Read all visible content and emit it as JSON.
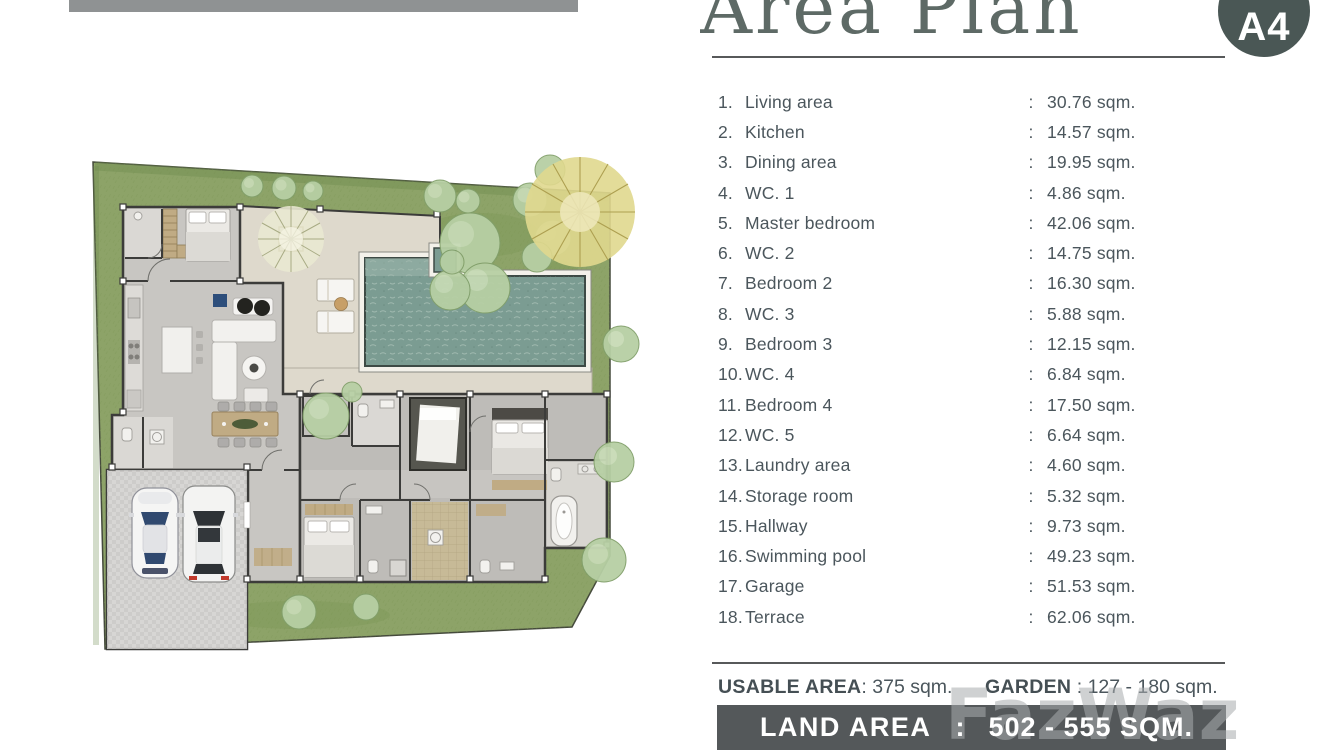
{
  "header": {
    "title": "Area Plan",
    "badge": "A4"
  },
  "misc": {
    "colon": ":"
  },
  "rooms": [
    {
      "no": "1.",
      "name": "Living area",
      "area": "30.76 sqm."
    },
    {
      "no": "2.",
      "name": "Kitchen",
      "area": "14.57 sqm."
    },
    {
      "no": "3.",
      "name": "Dining area",
      "area": "19.95 sqm."
    },
    {
      "no": "4.",
      "name": "WC. 1",
      "area": "4.86 sqm."
    },
    {
      "no": "5.",
      "name": "Master bedroom",
      "area": "42.06 sqm."
    },
    {
      "no": "6.",
      "name": "WC. 2",
      "area": "14.75 sqm."
    },
    {
      "no": "7.",
      "name": "Bedroom 2",
      "area": "16.30 sqm."
    },
    {
      "no": "8.",
      "name": "WC. 3",
      "area": "5.88 sqm."
    },
    {
      "no": "9.",
      "name": "Bedroom 3",
      "area": "12.15 sqm."
    },
    {
      "no": "10.",
      "name": "WC. 4",
      "area": "6.84 sqm."
    },
    {
      "no": "11.",
      "name": "Bedroom 4",
      "area": "17.50 sqm."
    },
    {
      "no": "12.",
      "name": "WC. 5",
      "area": "6.64 sqm."
    },
    {
      "no": "13.",
      "name": "Laundry area",
      "area": "4.60 sqm."
    },
    {
      "no": "14.",
      "name": "Storage room",
      "area": "5.32 sqm."
    },
    {
      "no": "15.",
      "name": "Hallway",
      "area": "9.73 sqm."
    },
    {
      "no": "16.",
      "name": "Swimming pool",
      "area": "49.23 sqm."
    },
    {
      "no": "17.",
      "name": "Garage",
      "area": "51.53 sqm."
    },
    {
      "no": "18.",
      "name": "Terrace",
      "area": "62.06 sqm."
    }
  ],
  "summary": {
    "usable_label": "USABLE AREA",
    "usable_value": ": 375 sqm.",
    "garden_label": "GARDEN",
    "garden_value": " : 127 - 180 sqm."
  },
  "land_area": {
    "label": "LAND AREA",
    "separator": ":",
    "value": "502 - 555 SQM."
  },
  "watermark": "FazWaz",
  "plan": {
    "elements": [
      "garden",
      "terrace",
      "swimming-pool",
      "spa",
      "house",
      "bedroom-wing",
      "garage",
      "two-cars",
      "trees",
      "sun-loungers"
    ],
    "colors": {
      "text": "#4b565c",
      "title": "#5e6a66",
      "badge_bg": "#4a5755",
      "badge_text": "#ffffff",
      "divider": "#57595a",
      "bar_bg": "#54585a",
      "bar_text": "#ffffff",
      "watermark": "#a9acae",
      "top_strip": "#8f9293",
      "grass": "#8da368",
      "grass_dark": "#76924f",
      "tree": "#b7cfa4",
      "tree_stroke": "#82a06b",
      "tree_light": "#d3e3c3",
      "fan": "#e0d88e",
      "fan_rays": "#ad9f50",
      "pool": "#7b9c92",
      "pool_light": "#9db6ac",
      "terrace": "#ded9cc",
      "floor": "#c8c6c2",
      "floor_light": "#dad8d4",
      "floor_dark": "#bebcb8",
      "wall": "#3c3c3a",
      "wood": "#c0ab84"
    }
  }
}
